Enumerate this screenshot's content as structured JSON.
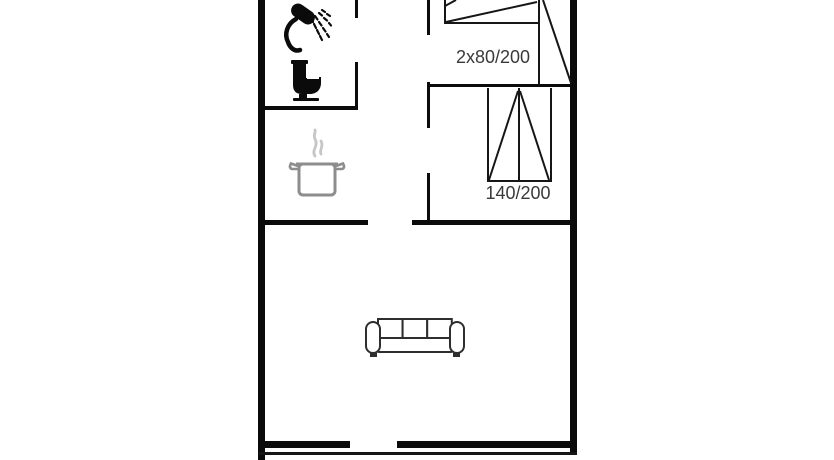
{
  "floorplan": {
    "bedroom1": {
      "bed_label": "2x80/200"
    },
    "bedroom2": {
      "bed_label": "140/200"
    },
    "icons": [
      {
        "name": "shower-icon"
      },
      {
        "name": "toilet-icon"
      },
      {
        "name": "cooking-pot-icon"
      },
      {
        "name": "sofa-icon"
      }
    ],
    "colors": {
      "wall": "#0b0b0b",
      "line": "#161616",
      "label_text": "#3a3a3a",
      "pot_outline": "#8d8d8d",
      "steam": "#c6c6c6",
      "sofa_outline": "#2e2e2e",
      "background": "#ffffff"
    }
  }
}
